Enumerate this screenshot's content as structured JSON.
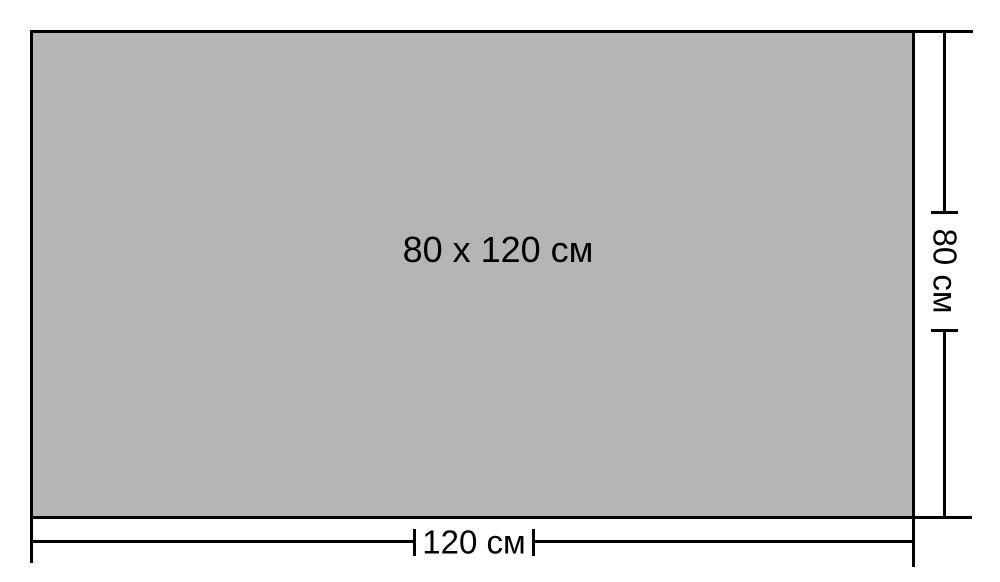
{
  "canvas": {
    "background": "#ffffff"
  },
  "rectangle": {
    "label": "80 x 120 см",
    "fill": "#b5b5b5",
    "border_color": "#000000"
  },
  "dimensions": {
    "width": {
      "label": "120 см"
    },
    "height": {
      "label": "80 см"
    }
  },
  "line_color": "#000000"
}
